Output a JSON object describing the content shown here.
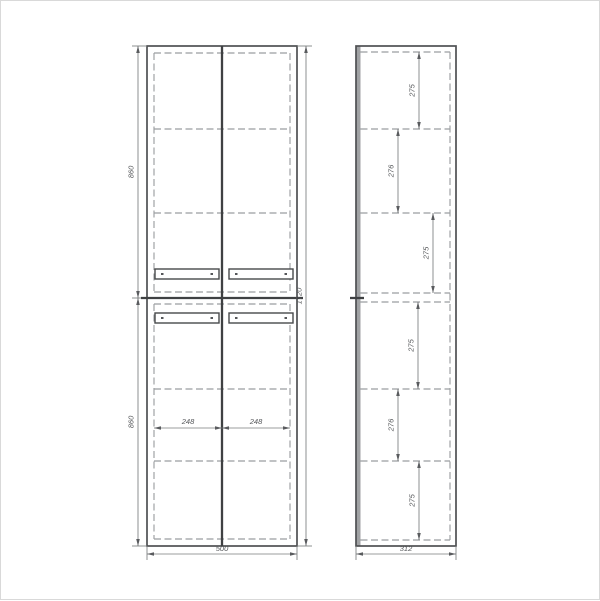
{
  "drawing": {
    "type": "technical-drawing",
    "subject": "two-view cabinet dimension drawing",
    "views": {
      "front": {
        "name": "front-view",
        "dim_labels": {
          "upper_section_height": "860",
          "lower_section_height": "860",
          "overall_height": "1720",
          "overall_width": "500",
          "left_door_width": "248",
          "right_door_width": "248"
        }
      },
      "side": {
        "name": "side-view",
        "dim_labels": {
          "overall_depth": "312",
          "shelf_spacings": [
            "275",
            "276",
            "275",
            "275",
            "276",
            "275"
          ]
        }
      }
    },
    "colors": {
      "background": "#ffffff",
      "outline": "#4f5153",
      "hidden_line": "#9b9ea1",
      "dimension_line": "#7a7c7e",
      "text": "#55575a",
      "frame_border": "#d9d9d9"
    }
  },
  "geometry": {
    "canvas": {
      "w": 600,
      "h": 600
    },
    "front": {
      "x1": 146,
      "x2": 296,
      "y1": 45,
      "y2": 545,
      "center_x": 221,
      "split_y": 297,
      "inner_x1": 153,
      "inner_x2": 289,
      "inner_y_top": 52,
      "inner_y_upper_bottom": 291,
      "inner_y_lower_top": 303,
      "inner_y_bottom": 538,
      "shelves_y": [
        128,
        212,
        388,
        460
      ],
      "handles": [
        {
          "x": 154,
          "y": 268
        },
        {
          "x": 228,
          "y": 268
        },
        {
          "x": 154,
          "y": 312
        },
        {
          "x": 228,
          "y": 312
        }
      ],
      "handle_w": 64,
      "handle_h": 10,
      "dim_left_x": 137,
      "dim_right_x": 305,
      "dim_bottom_y": 553,
      "dim_door_y": 427
    },
    "side": {
      "x1": 355,
      "x2": 455,
      "y1": 45,
      "y2": 545,
      "face_w": 4.5,
      "hidden_x": 449,
      "split_y": 297,
      "inner_y_top": 51,
      "inner_y_bottom": 539,
      "shelves_y": [
        128,
        212,
        292,
        301,
        388,
        460
      ],
      "segments": [
        {
          "a": 51,
          "b": 128,
          "x": 418
        },
        {
          "a": 128,
          "b": 212,
          "x": 397
        },
        {
          "a": 212,
          "b": 292,
          "x": 432
        },
        {
          "a": 301,
          "b": 388,
          "x": 417
        },
        {
          "a": 388,
          "b": 460,
          "x": 397
        },
        {
          "a": 460,
          "b": 539,
          "x": 418
        }
      ],
      "dim_bottom_y": 553
    }
  }
}
